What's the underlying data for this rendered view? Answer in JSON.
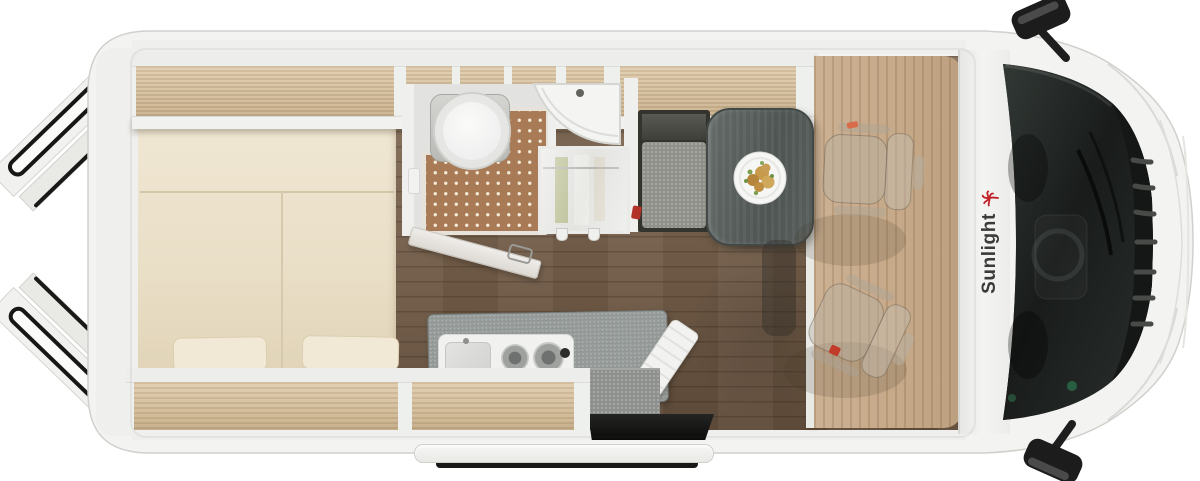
{
  "brand": {
    "name": "Sunlight"
  },
  "vehicle": {
    "view": "top-down-floorplan",
    "kind": "camper-van"
  },
  "colors": {
    "body": "#f3f3f1",
    "body_outline": "#d0d0cd",
    "bed": "#ece2cb",
    "pillow": "#f1e9d6",
    "shelf_wood": "#d4be9d",
    "floor_corridor": "#7a6450",
    "floor_cab": "#c2a482",
    "shower_mat": "#a87a55",
    "mat_dots": "#f4ead8",
    "kitchen_counter": "#8f9492",
    "dinette_table": "#555c5a",
    "bench_cushion": "#90918a",
    "windshield": "#1d211f",
    "brand_text": "#3b3b3b",
    "brand_palm": "#c22026",
    "accent_red": "#c23a28"
  },
  "parts": [
    "rear-doors-open",
    "roof-rails",
    "rear-bed",
    "bed-pillows",
    "overhead-shelf-rear",
    "overhead-lockers-bathroom",
    "overhead-shelf-dinette",
    "lower-shelf-bed",
    "lower-shelf-kitchen",
    "toilet",
    "shower-mat",
    "bathroom-door",
    "washbasin",
    "wardrobe",
    "dinette-bench",
    "dinette-table",
    "meal-plate",
    "kitchen-counter",
    "sink-two-burner-hob",
    "cutting-board",
    "entry-step",
    "entry-doorwell",
    "swivel-cab-seat-passenger",
    "swivel-cab-seat-driver",
    "front-wall",
    "brand-logo",
    "windshield",
    "wiper",
    "grille",
    "hood",
    "side-mirror-top",
    "side-mirror-bottom"
  ]
}
